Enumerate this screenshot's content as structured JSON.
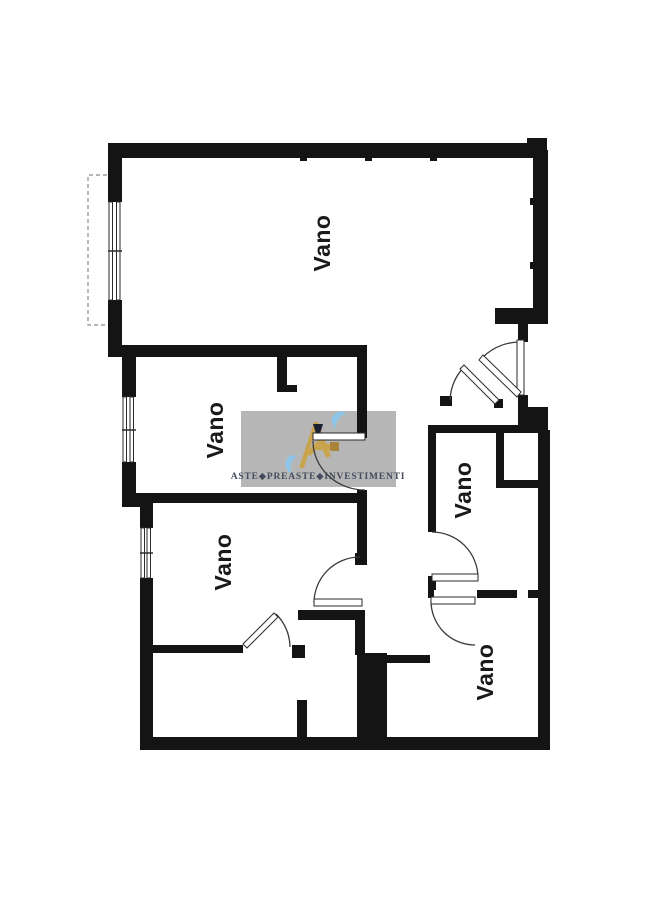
{
  "floorplan": {
    "rooms": [
      {
        "id": "top",
        "label": "Vano"
      },
      {
        "id": "middle-left",
        "label": "Vano"
      },
      {
        "id": "bottom-left",
        "label": "Vano"
      },
      {
        "id": "right-middle",
        "label": "Vano"
      },
      {
        "id": "bottom-right",
        "label": "Vano"
      }
    ],
    "colors": {
      "wall": "#141414",
      "background": "#ffffff",
      "label": "#1a1a1a",
      "watermark_bg": "#b3b3b3",
      "watermark_text": "#454a5c",
      "logo_gold": "#c9a44e",
      "logo_gold_dark": "#a8853a",
      "logo_navy": "#1c2030",
      "logo_blue": "#8fc6e8"
    }
  },
  "watermark": {
    "brand_text": "ASTE◆PREASTE◆INVESTIMENTI"
  }
}
